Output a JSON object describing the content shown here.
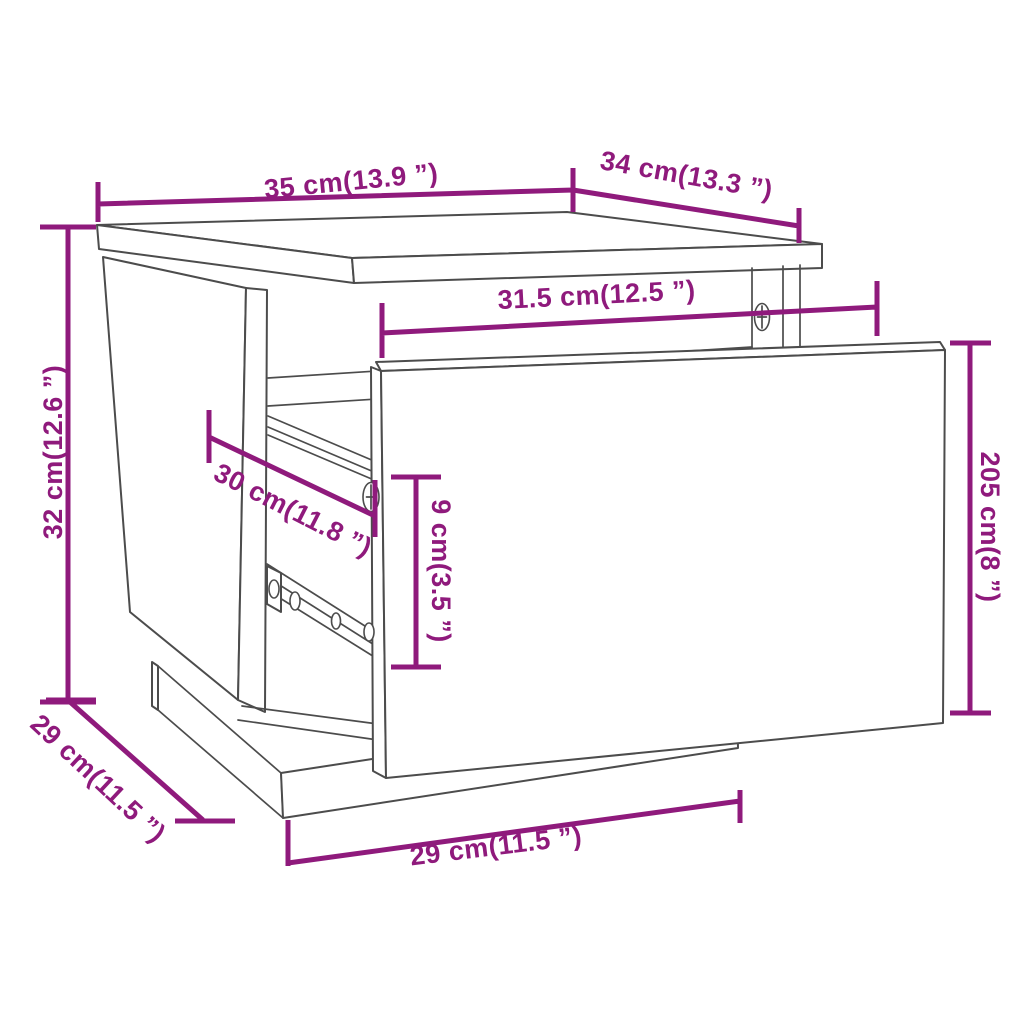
{
  "diagram": {
    "kind": "furniture technical dimension drawing",
    "subject": "bedside cabinet with pulled-out drawer front",
    "background": "#ffffff"
  },
  "style": {
    "dimension_color": "#8F1A7C",
    "outline_color": "#4C4C4C"
  },
  "dimensions": [
    {
      "id": "top-width",
      "label": "35 cm(13.9 ”)",
      "value_cm": "35",
      "value_in": "13.9"
    },
    {
      "id": "top-depth",
      "label": "34 cm(13.3 ”)",
      "value_cm": "34",
      "value_in": "13.3"
    },
    {
      "id": "inner-width",
      "label": "31.5 cm(12.5 ”)",
      "value_cm": "31.5",
      "value_in": "12.5"
    },
    {
      "id": "overall-height",
      "label": "32 cm(12.6 ”)",
      "value_cm": "32",
      "value_in": "12.6"
    },
    {
      "id": "slide-depth",
      "label": "30 cm(11.8 ”)",
      "value_cm": "30",
      "value_in": "11.8"
    },
    {
      "id": "drawer-inner-height",
      "label": "9 cm(3.5 ”)",
      "value_cm": "9",
      "value_in": "3.5"
    },
    {
      "id": "drawer-front-height",
      "label": "205 cm(8 ”)",
      "value_cm": "205",
      "value_in": "8"
    },
    {
      "id": "base-depth",
      "label": "29 cm(11.5 ”)",
      "value_cm": "29",
      "value_in": "11.5"
    },
    {
      "id": "base-width",
      "label": "29 cm(11.5 ”)",
      "value_cm": "29",
      "value_in": "11.5"
    }
  ]
}
